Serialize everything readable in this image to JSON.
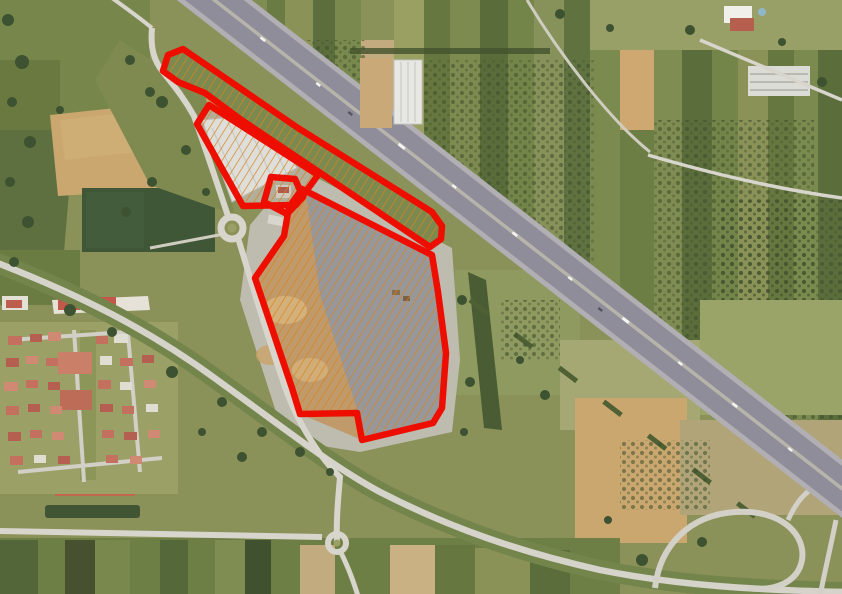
{
  "map": {
    "view": "aerial-satellite-imagery",
    "canvas": {
      "width": 842,
      "height": 594
    },
    "palette": {
      "annotation_red": "#ee0e00",
      "hatch_orange": "#d8831c",
      "highway_asphalt": "#8e8d99",
      "highway_shoulder": "#b1afb3",
      "highway_median": "#b7b5ab",
      "local_road": "#d7d5cc",
      "field_olive_base": "#8a9159",
      "plowed_tan": "#c9a76f",
      "graded_lot_gray": "#9b9aa0",
      "pond_dark_green": "#3f5637",
      "roof_red": "#c4705e",
      "warehouse_white": "#e3e4e0"
    },
    "annotation": {
      "stroke_color": "#ee0e00",
      "stroke_width": 6.5,
      "hatch": {
        "color": "#d8831c",
        "spacing": 7,
        "line_width": 1.4,
        "angle_deg": -58
      }
    },
    "parcels": [
      {
        "id": "parcel-highway-strip",
        "hatched": true,
        "ground": "#7c8a4f",
        "points": [
          [
            163,
            71
          ],
          [
            168,
            55
          ],
          [
            183,
            49
          ],
          [
            298,
            128
          ],
          [
            432,
            212
          ],
          [
            442,
            226
          ],
          [
            441,
            239
          ],
          [
            430,
            247
          ],
          [
            310,
            166
          ],
          [
            240,
            119
          ],
          [
            205,
            93
          ],
          [
            178,
            82
          ]
        ]
      },
      {
        "id": "parcel-warehouse",
        "hatched": true,
        "ground": null,
        "points": [
          [
            209,
            105
          ],
          [
            318,
            175
          ],
          [
            296,
            205
          ],
          [
            243,
            206
          ],
          [
            197,
            124
          ]
        ]
      },
      {
        "id": "parcel-central",
        "hatched": true,
        "ground": null,
        "points": [
          [
            302,
            189
          ],
          [
            432,
            255
          ],
          [
            438,
            292
          ],
          [
            446,
            353
          ],
          [
            442,
            408
          ],
          [
            433,
            423
          ],
          [
            362,
            440
          ],
          [
            357,
            413
          ],
          [
            300,
            414
          ],
          [
            292,
            388
          ],
          [
            255,
            278
          ],
          [
            284,
            236
          ],
          [
            289,
            207
          ]
        ]
      },
      {
        "id": "parcel-small-building",
        "hatched": false,
        "ground": null,
        "points": [
          [
            271,
            177
          ],
          [
            295,
            179
          ],
          [
            303,
            197
          ],
          [
            287,
            214
          ],
          [
            264,
            202
          ]
        ]
      }
    ]
  }
}
